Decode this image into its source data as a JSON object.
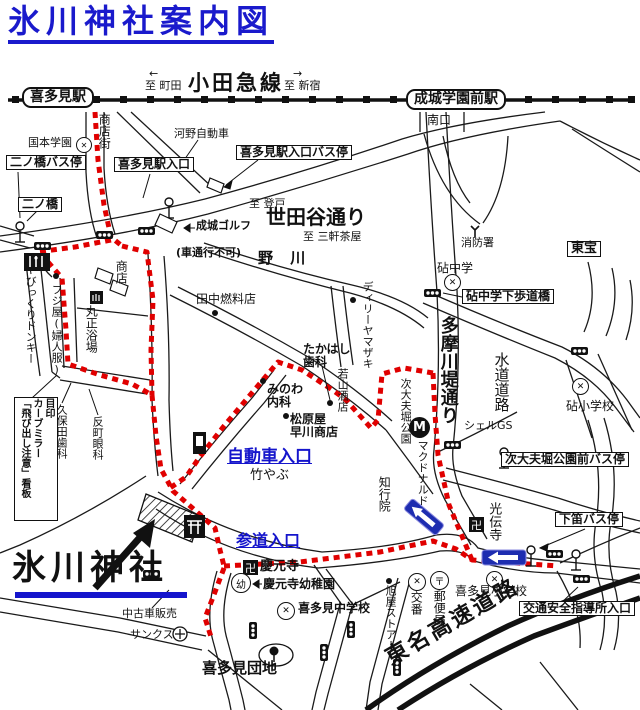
{
  "title": "氷川神社案内図",
  "colors": {
    "title_blue": "#1a1acc",
    "route_red": "#e00000",
    "link_blue": "#1515cc",
    "sign_blue": "#1e2db0"
  },
  "railway": {
    "name": "小田急線",
    "left_dest": "至 町田",
    "left_arrow": "←",
    "right_dest": "至 新宿",
    "right_arrow": "→",
    "station_left": "喜多見駅",
    "station_right": "成城学園前駅",
    "south_exit": "南口"
  },
  "roads": {
    "setagaya_dori": "世田谷通り",
    "to_noborito": "至 登戸",
    "to_sangenjaya": "至 三軒茶屋",
    "nogawa_river": "野 川",
    "tamagawa_tsutsumi_dori": "多摩川堤通り",
    "suido_road": "水道道路",
    "tomei_expressway": "東名高速道路",
    "shotengai": "商店街",
    "no_vehicle_note": "(車通行不可)"
  },
  "shrine": {
    "name": "氷川神社",
    "car_entrance": "自動車入口",
    "sando_entrance": "参道入口"
  },
  "bus_stops": {
    "ninohashi": "二ノ橋バス停",
    "kitami_eki_iriguchi": "喜多見駅入口バス停",
    "jidayubori_koen_mae": "次大夫堀公園前バス停",
    "shimobue": "下笛バス停"
  },
  "boxes": {
    "ninohashi": "二ノ橋",
    "kitami_eki_iriguchi": "喜多見駅入口",
    "toho": "東宝",
    "kinuta_hodokyo": "砧中学下歩道橋",
    "kotsu_anzen": "交通安全指導所入口",
    "landmark_sign": "目印\nカーブミラー\n「飛び出し注意」看板"
  },
  "places": {
    "kunimoto_gakuen": "国本学園",
    "kono_jidosha": "河野自動車",
    "seijo_golf": "成城ゴルフ",
    "shoten": "商店",
    "fujiya": "フジ屋(婦人服)",
    "bikkuri_donkey": "びっくりドンキー",
    "marusho_yokujo": "丸正浴場",
    "tanaka_nenryoten": "田中燃料店",
    "kubota_shika": "久保田歯科",
    "sorimachi_ganka": "反町眼科",
    "minowa_naika": "みのわ\n内科",
    "takahashi_shika": "たかはし\n歯科",
    "matsubaraya_hayakawa": "松原屋\n早川商店",
    "takeyabu": "竹やぶ",
    "daily_yamazaki": "ディリーヤマザキ",
    "wakayama_saketen": "若山酒店",
    "jidayubori_koen": "次大夫堀公園",
    "mcdonalds": "マクドナルド",
    "shell_gs": "シェルGS",
    "chigyoin": "知行院",
    "kodenji": "光伝寺",
    "shobosho": "消防署",
    "kinuta_chugaku": "砧中学",
    "kinuta_shogakko": "砧小学校",
    "keigenji": "慶元寺",
    "keigenji_yochien": "慶元寺幼稚園",
    "kitami_chugakko": "喜多見中学校",
    "kitami_shogakko": "喜多見小学校",
    "yubinkyoku": "郵便局",
    "koban": "交番",
    "asahiya_store": "旭屋ストアー",
    "chukosha_hanbai": "中古車販売",
    "sunkus": "サンクス",
    "kitami_danchi": "喜多見団地"
  },
  "icons": {
    "mcdonalds_m": "M",
    "manji": "卍",
    "post": "〒",
    "x_mark": "✕",
    "kindergarten": "幼",
    "left_arrow": "←",
    "right_arrow": "→"
  }
}
